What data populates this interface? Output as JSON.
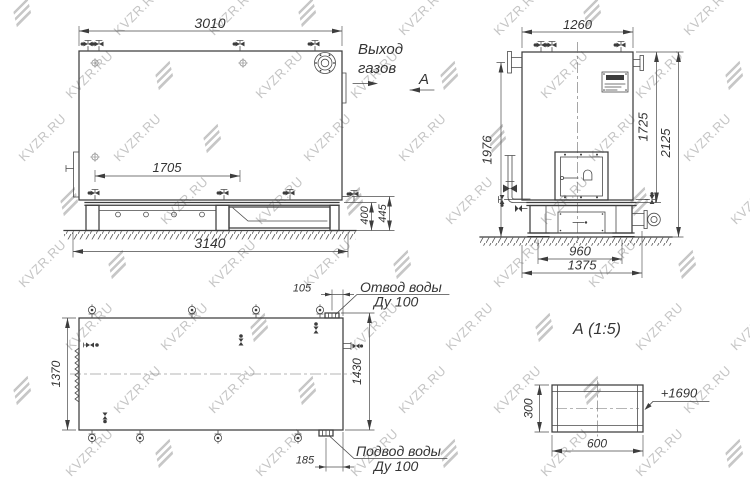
{
  "watermark": {
    "text": "KVZR.RU"
  },
  "side_view": {
    "dim_top_width": "3010",
    "dim_grate_length": "1705",
    "dim_base_length": "3140",
    "dim_base_height": "400",
    "dim_base_height_total": "445",
    "label_gas_outlet_line1": "Выход",
    "label_gas_outlet_line2": "газов",
    "section_arrow_label": "А"
  },
  "front_view": {
    "dim_top_width": "1260",
    "dim_height_to_pipe": "1976",
    "dim_body_height": "1725",
    "dim_total_height": "2125",
    "dim_base_inner_width": "960",
    "dim_base_width": "1375"
  },
  "plan_view": {
    "dim_width_left": "1370",
    "dim_width_right": "1430",
    "dim_outlet_offset": "105",
    "dim_inlet_offset": "185",
    "label_water_outlet_line1": "Отвод воды",
    "label_water_outlet_line2": "Ду 100",
    "label_water_inlet_line1": "Подвод воды",
    "label_water_inlet_line2": "Ду 100"
  },
  "detail_a": {
    "title": "А  (1:5)",
    "dim_height": "300",
    "dim_width": "600",
    "elevation_mark": "+1690"
  }
}
